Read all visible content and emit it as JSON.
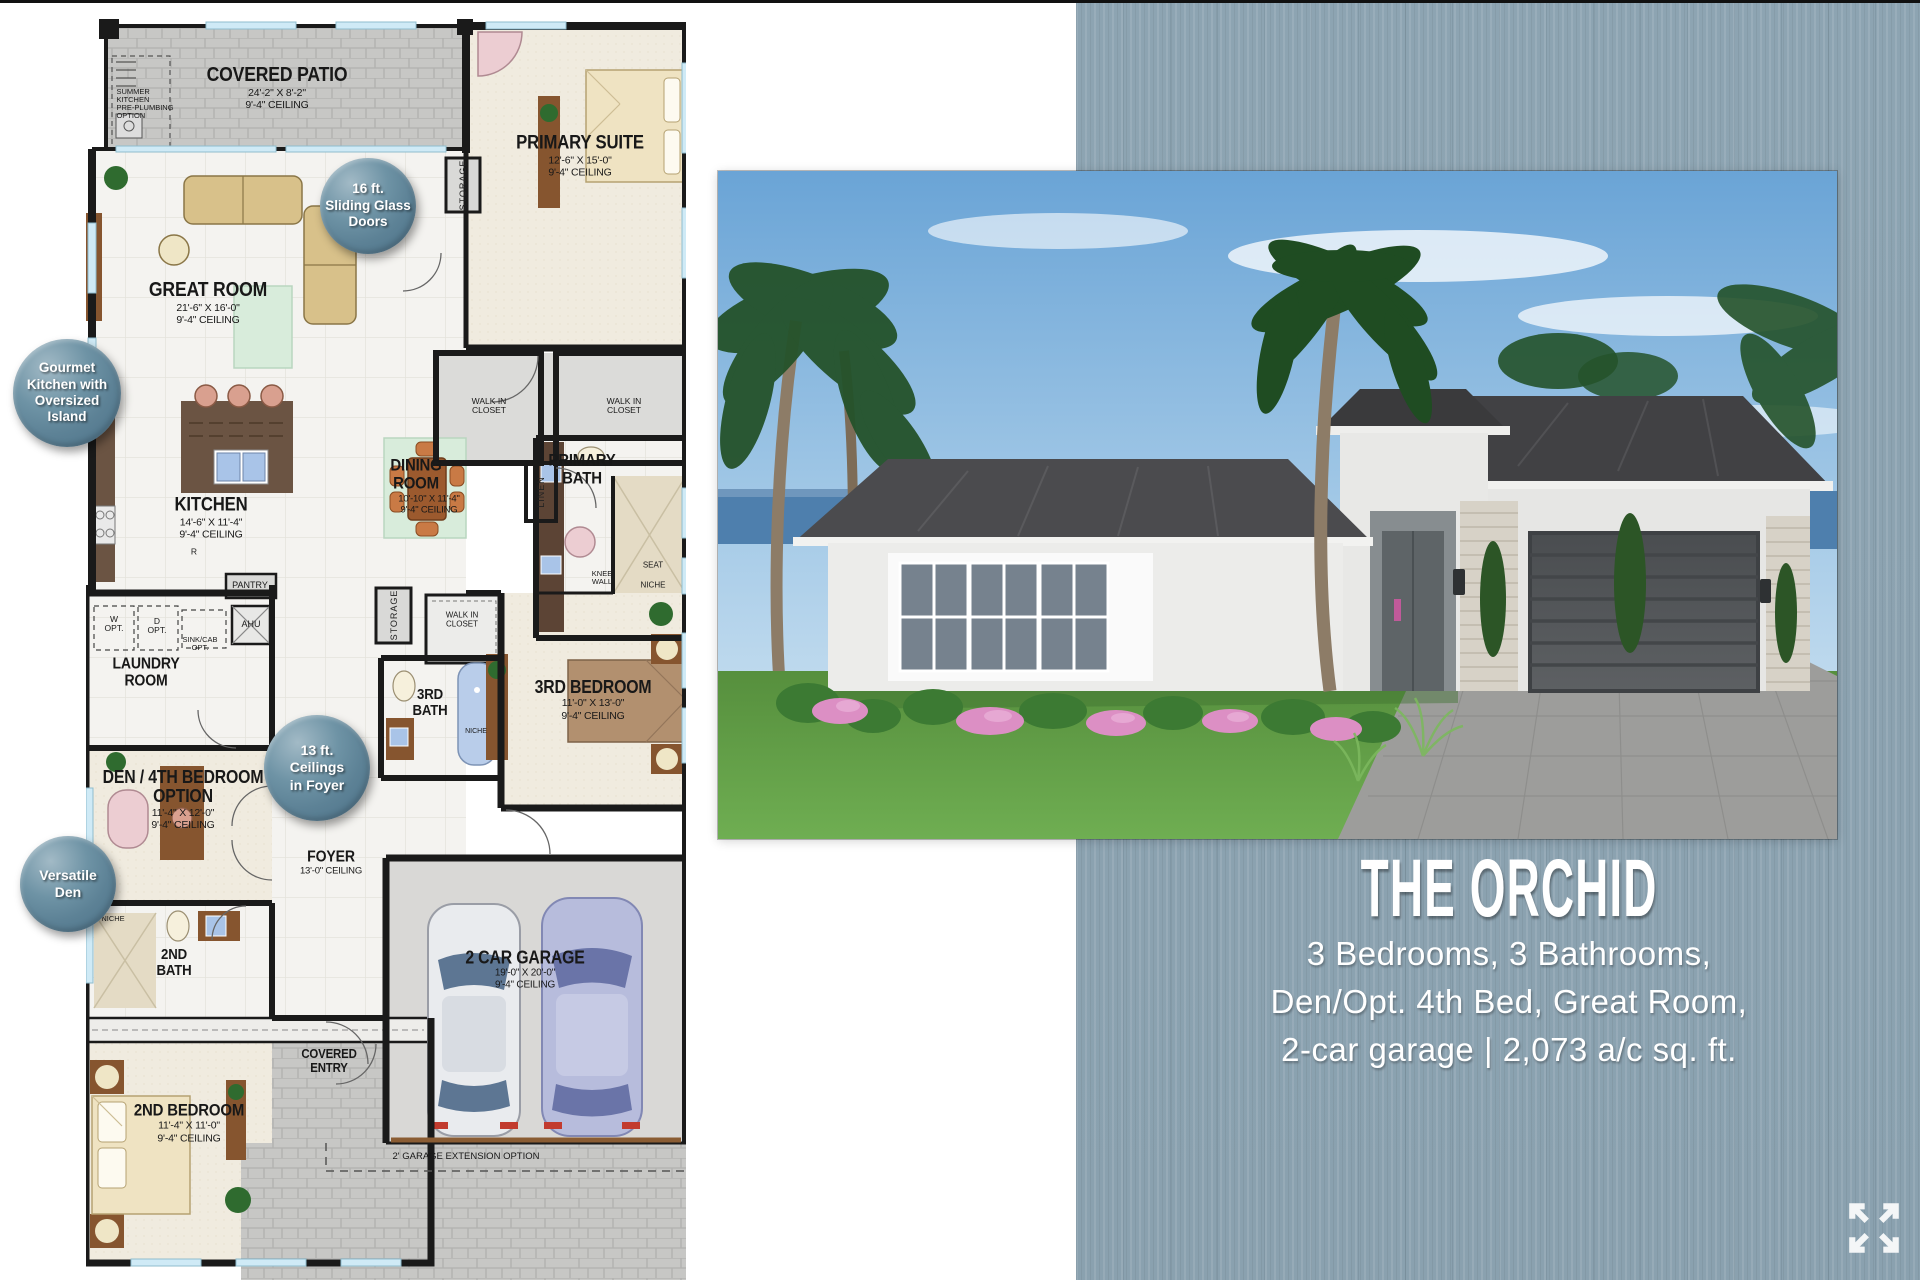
{
  "page": {
    "background": "#ffffff",
    "panel_blue": "#8da4b2",
    "badge_blue": "#5d8296",
    "wall_black": "#1a1a1a"
  },
  "title_block": {
    "name": "THE ORCHID",
    "line1": "3 Bedrooms, 3 Bathrooms,",
    "line2": "Den/Opt. 4th Bed, Great Room,",
    "line3": "2-car garage  |  2,073 a/c sq. ft."
  },
  "badges": {
    "sliding_doors": "16 ft.\nSliding Glass\nDoors",
    "gourmet_kitchen": "Gourmet\nKitchen with\nOversized\nIsland",
    "foyer_ceilings": "13 ft.\nCeilings\nin Foyer",
    "versatile_den": "Versatile\nDen"
  },
  "floorplan": {
    "rooms": {
      "covered_patio": {
        "name": "COVERED PATIO",
        "dims": "24'-2\" X 8'-2\"",
        "ceiling": "9'-4\" CEILING"
      },
      "primary_suite": {
        "name": "PRIMARY SUITE",
        "dims": "12'-6\" X 15'-0\"",
        "ceiling": "9'-4\" CEILING"
      },
      "great_room": {
        "name": "GREAT ROOM",
        "dims": "21'-6\" X 16'-0\"",
        "ceiling": "9'-4\" CEILING"
      },
      "kitchen": {
        "name": "KITCHEN",
        "dims": "14'-6\" X 11'-4\"",
        "ceiling": "9'-4\" CEILING"
      },
      "dining_room": {
        "name": "DINING ROOM",
        "dims": "10'-10\" X 11'-4\"",
        "ceiling": "9'-4\" CEILING"
      },
      "primary_bath": {
        "name": "PRIMARY BATH"
      },
      "laundry_room": {
        "name": "LAUNDRY ROOM"
      },
      "den": {
        "name": "DEN / 4TH BEDROOM OPTION",
        "dims": "11'-4\" X 12'-0\"",
        "ceiling": "9'-4\" CEILING"
      },
      "foyer": {
        "name": "FOYER",
        "ceiling": "13'-0\" CEILING"
      },
      "third_bath": {
        "name": "3RD BATH"
      },
      "third_bedroom": {
        "name": "3RD BEDROOM",
        "dims": "11'-0\" X 13'-0\"",
        "ceiling": "9'-4\" CEILING"
      },
      "second_bath": {
        "name": "2ND BATH"
      },
      "second_bedroom": {
        "name": "2ND BEDROOM",
        "dims": "11'-4\" X 11'-0\"",
        "ceiling": "9'-4\" CEILING"
      },
      "garage": {
        "name": "2 CAR GARAGE",
        "dims": "19'-0\" X 20'-0\"",
        "ceiling": "9'-4\" CEILING"
      },
      "covered_entry": {
        "name": "COVERED ENTRY"
      }
    },
    "labels": {
      "summer_kitchen": "SUMMER\nKITCHEN\nPRE-PLUMBING\nOPTION",
      "storage": "STORAGE",
      "walk_in_closet": "WALK IN\nCLOSET",
      "linen": "LINEN",
      "pantry": "PANTRY",
      "ahu": "AHU",
      "w_opt": "W\nOPT.",
      "d_opt": "D\nOPT.",
      "sink_cab_opt": "SINK/CAB\nOPT.",
      "knee_wall": "KNEE\nWALL",
      "seat": "SEAT",
      "niche": "NICHE",
      "range": "R",
      "garage_extension": "2' GARAGE EXTENSION OPTION"
    }
  }
}
